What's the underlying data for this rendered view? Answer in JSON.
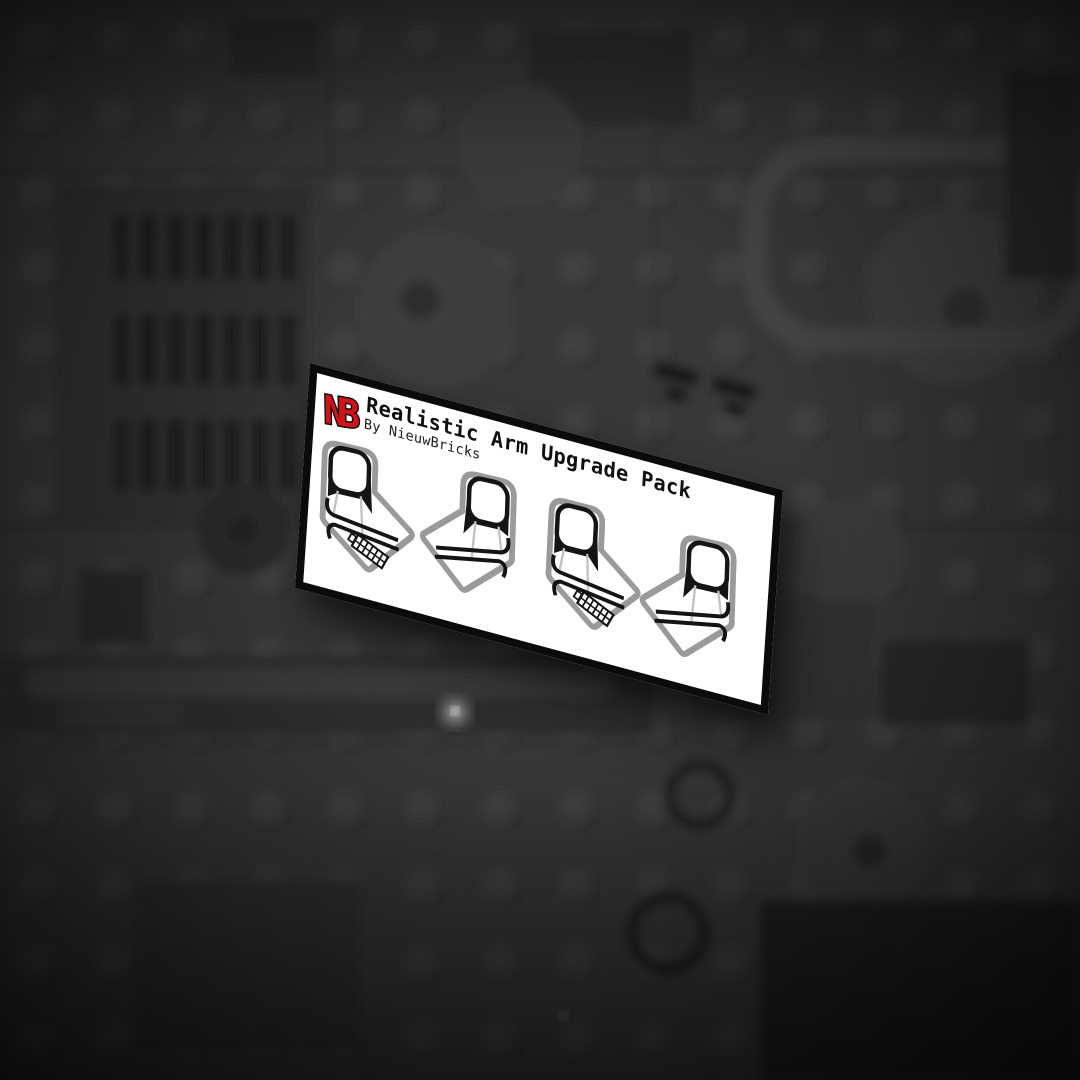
{
  "card": {
    "logo_text": "NB",
    "title": "Realistic Arm Upgrade Pack",
    "subtitle": "By NieuwBricks",
    "arms": [
      {
        "id": 1,
        "name": "arm-illustration-left-zipper",
        "mirrored": false,
        "zipper": true,
        "x": 12,
        "y": 60,
        "rot": -2
      },
      {
        "id": 2,
        "name": "arm-illustration-right-plain",
        "mirrored": true,
        "zipper": false,
        "x": 110,
        "y": 55,
        "rot": 2
      },
      {
        "id": 3,
        "name": "arm-illustration-left-zipper",
        "mirrored": false,
        "zipper": true,
        "x": 246,
        "y": 57,
        "rot": -1
      },
      {
        "id": 4,
        "name": "arm-illustration-right-plain",
        "mirrored": true,
        "zipper": false,
        "x": 338,
        "y": 60,
        "rot": 2
      }
    ]
  },
  "palette": {
    "accent_red": "#d01219",
    "card_background": "#ffffff",
    "card_border": "#0b0b0b",
    "arm_outline_gray": "#9a9a9a",
    "print_black": "#141414",
    "seam_gray": "#c2c2c2",
    "background_base": "#383838"
  }
}
